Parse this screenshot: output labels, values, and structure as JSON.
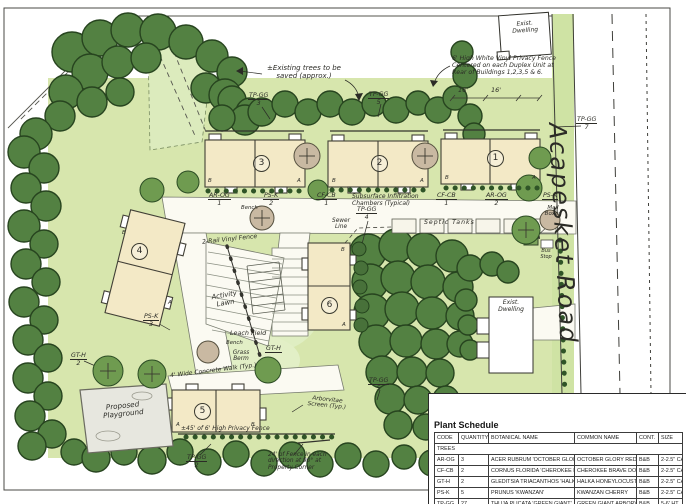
{
  "road": {
    "name": "Acapesket Road"
  },
  "notes": {
    "privacy_fence": "6' High White Vinyl Privacy Fence Centered on each Duplex Unit at Rear of Buildings 1,2,3,5 & 6.",
    "existing_trees": "±Existing trees to be saved (approx.)",
    "privacy_fence_b5": "±45' of 6' High Privacy Fence",
    "corner_fence": "24' of Fence in each direction at 90° at Property Corner"
  },
  "structures": {
    "exist_dwelling_top": "Exist. Dwelling",
    "exist_dwelling_right": "Exist. Dwelling",
    "playground": "Proposed Playground"
  },
  "features": {
    "septic_tanks": "Septic Tanks",
    "sewer_line": "Sewer Line",
    "infiltration": "Subsurface Infiltration Chambers (Typical)",
    "rail_fence": "2-Rail Vinyl Fence",
    "activity_lawn": "Activity Lawn",
    "leach_field": "Leach Field",
    "bench_front": "Bench",
    "bench_leach": "Bench",
    "mail_boxes": "Mail Boxes",
    "bus_stop": "Bus Stop",
    "concrete_walk": "4' Wide Concrete Walk (Typ.)",
    "grass_berm": "Grass Berm",
    "arborvitae_screen": "Arborvitae Screen (Typ.)"
  },
  "dims": [
    "16'",
    "16'"
  ],
  "buildings": [
    {
      "number": "1",
      "units": [
        "B",
        "A"
      ]
    },
    {
      "number": "2",
      "units": [
        "B",
        "A"
      ]
    },
    {
      "number": "3",
      "units": [
        "B",
        "A"
      ]
    },
    {
      "number": "4",
      "units": [
        "B",
        "A"
      ]
    },
    {
      "number": "5",
      "units": [
        "A",
        "B"
      ]
    },
    {
      "number": "6",
      "units": [
        "B",
        "A"
      ]
    }
  ],
  "callouts": [
    {
      "code": "TP-GG",
      "qty": "3"
    },
    {
      "code": "TP-GG",
      "qty": "5"
    },
    {
      "code": "TP-GG",
      "qty": "7"
    },
    {
      "code": "TP-GG",
      "qty": "4"
    },
    {
      "code": "TP-GG",
      "qty": "5"
    },
    {
      "code": "TP-GG",
      "qty": "2"
    },
    {
      "code": "AR-OG",
      "qty": "1"
    },
    {
      "code": "PS-K",
      "qty": "2"
    },
    {
      "code": "CF-CB",
      "qty": "1"
    },
    {
      "code": "CF-CB",
      "qty": "1"
    },
    {
      "code": "AR-OG",
      "qty": "2"
    },
    {
      "code": "PS-K",
      "qty": ""
    },
    {
      "code": "PS-K",
      "qty": "3"
    },
    {
      "code": "GT-H",
      "qty": "2"
    },
    {
      "code": "GT-H",
      "qty": ""
    }
  ],
  "schedule": {
    "title": "Plant Schedule",
    "headers": [
      "CODE",
      "QUANTITY",
      "BOTANICAL NAME",
      "COMMON NAME",
      "CONT.",
      "SIZE"
    ],
    "section": "TREES",
    "rows": [
      {
        "code": "AR-OG",
        "qty": "3",
        "botanical": "ACER RUBRUM 'OCTOBER GLORY'",
        "common": "OCTOBER GLORY RED MAPLE",
        "cont": "B&B",
        "size": "2-2.5\" CAL."
      },
      {
        "code": "CF-CB",
        "qty": "2",
        "botanical": "CORNUS FLORIDA 'CHEROKEE BRAVE'",
        "common": "CHEROKEE BRAVE DOGWOOD",
        "cont": "B&B",
        "size": "2-2.5\" CAL."
      },
      {
        "code": "GT-H",
        "qty": "2",
        "botanical": "GLEDITSIA TRIACANTHOS 'HALKA'",
        "common": "HALKA HONEYLOCUST",
        "cont": "B&B",
        "size": "2-2.5\" CAL."
      },
      {
        "code": "PS-K",
        "qty": "5",
        "botanical": "PRUNUS 'KWANZAN'",
        "common": "KWANZAN CHERRY",
        "cont": "B&B",
        "size": "2-2.5\" CAL."
      },
      {
        "code": "TP-GG",
        "qty": "27",
        "botanical": "THUJA PLICATA 'GREEN GIANT'",
        "common": "GREEN GIANT ARBORVITAE",
        "cont": "B&B",
        "size": "5-6' HT."
      }
    ]
  },
  "colors": {
    "canopy": "#538142",
    "canopy_outline": "#27441f",
    "lawn": "#d7e6ad",
    "building": "#f3e9c6",
    "ink": "#2b2b26",
    "playground": "#e7e7df",
    "paper": "#ffffff"
  }
}
